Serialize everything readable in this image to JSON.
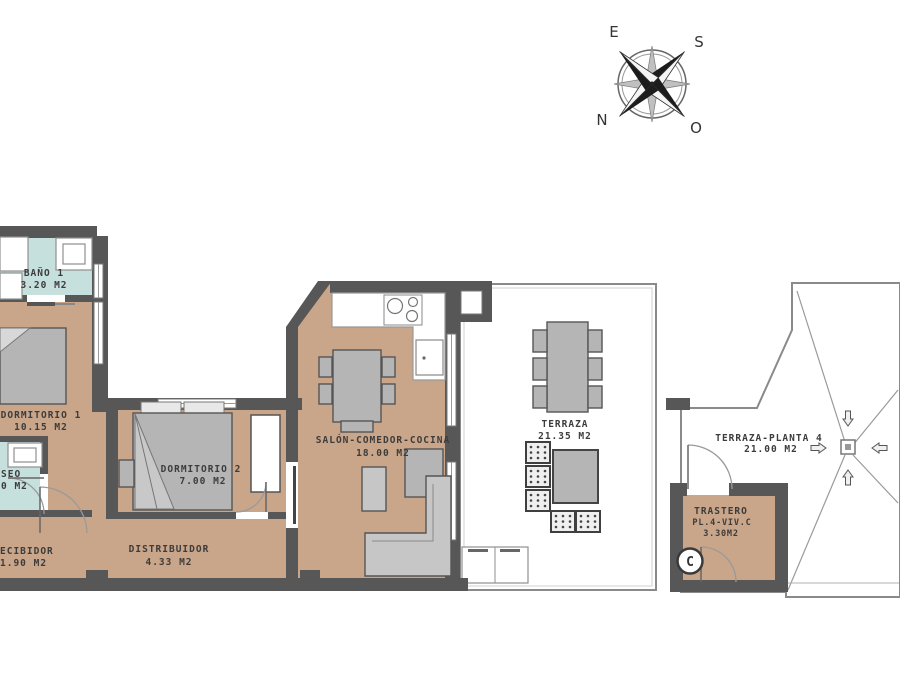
{
  "compass": {
    "top_left": "E",
    "top_right": "S",
    "bottom_left": "N",
    "bottom_right": "O"
  },
  "rooms": {
    "bano1": {
      "name": "BAÑO 1",
      "area": "3.20 M2"
    },
    "dormitorio1": {
      "name": "DORMITORIO 1",
      "area": "10.15 M2"
    },
    "aseo": {
      "name": "SEO",
      "area": "0 M2"
    },
    "recibidor": {
      "name": "ECIBIDOR",
      "area": "1.90 M2"
    },
    "distribuidor": {
      "name": "DISTRIBUIDOR",
      "area": "4.33 M2"
    },
    "dormitorio2": {
      "name": "DORMITORIO 2",
      "area": "7.00 M2"
    },
    "salon": {
      "name": "SALÓN-COMEDOR-COCINA",
      "area": "18.00 M2"
    },
    "terraza": {
      "name": "TERRAZA",
      "area": "21.35 M2"
    },
    "terraza_planta4": {
      "name": "TERRAZA-PLANTA 4",
      "area": "21.00 M2"
    },
    "trastero": {
      "name": "TRASTERO",
      "unit": "PL.4-VIV.C",
      "area": "3.30M2"
    }
  },
  "unit_marker": "C",
  "colors": {
    "floor": "#c9a589",
    "wet_floor": "#c6e0de",
    "wall": "#575757",
    "furniture": "#b5b5b5",
    "tile_floor": "#e4e4e4",
    "outline": "#8a8a8a"
  }
}
